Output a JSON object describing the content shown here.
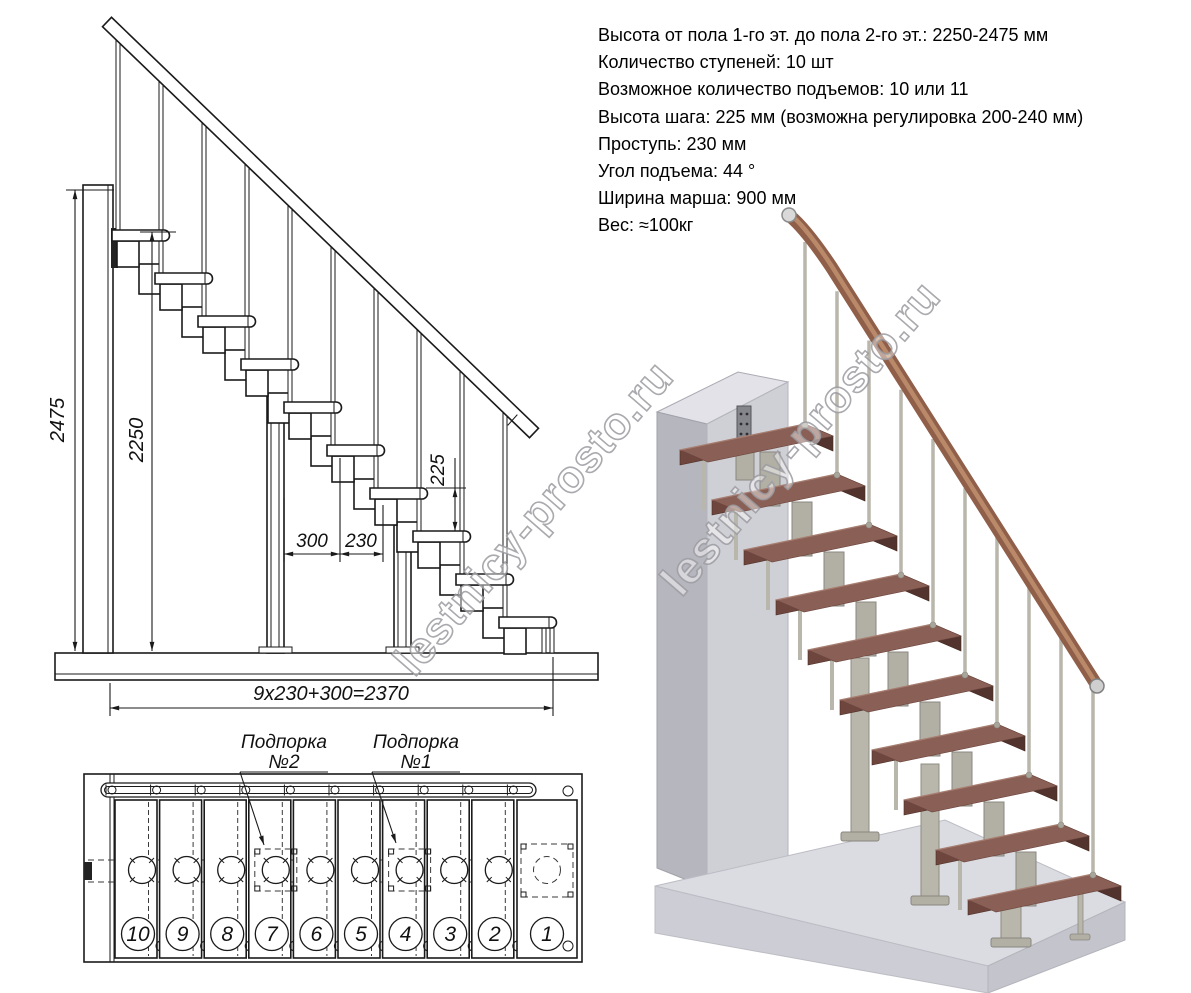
{
  "specs": {
    "lines": [
      "Высота от пола 1-го эт. до пола 2-го эт.: 2250-2475 мм",
      "Количество ступеней: 10 шт",
      "Возможное количество подъемов: 10 или 11",
      "Высота шага: 225 мм (возможна регулировка 200-240 мм)",
      "Проступь: 230 мм",
      "Угол подъема: 44 °",
      "Ширина марша: 900 мм",
      "Вес: ≈100кг"
    ]
  },
  "stair": {
    "steps_total": 10
  },
  "side_view": {
    "dims": {
      "total_height": "2475",
      "floor_height": "2250",
      "step_height": "225",
      "run_300": "300",
      "tread_230": "230",
      "total_run": "9x230+300=2370"
    }
  },
  "plan_view": {
    "support2_line1": "Подпорка",
    "support2_line2": "№2",
    "support1_line1": "Подпорка",
    "support1_line2": "№1",
    "step_numbers": [
      "10",
      "9",
      "8",
      "7",
      "6",
      "5",
      "4",
      "3",
      "2",
      "1"
    ]
  },
  "watermark": {
    "text": "lestnicy-prosto.ru"
  },
  "colors": {
    "wood_tread_top": "#8a5f55",
    "wood_tread_front": "#6f463e",
    "wood_tread_side": "#53332d",
    "rail_wood": "#8f5f4a",
    "rail_highlight": "#c1906f",
    "metal_post": "#b9b6ac",
    "metal_post_edge": "#8f8c82",
    "plate_metal": "#b2afa5",
    "wall_top": "#e2e2e8",
    "wall_front": "#cfcfd6",
    "wall_side": "#b6b6be",
    "floor_top": "#dbdbe2",
    "floor_front": "#cdcdd5",
    "floor_side": "#c4c4cc",
    "bracket": "#85858c",
    "line": "#1a1a1a",
    "watermark_gray": "#9a9aa0"
  }
}
